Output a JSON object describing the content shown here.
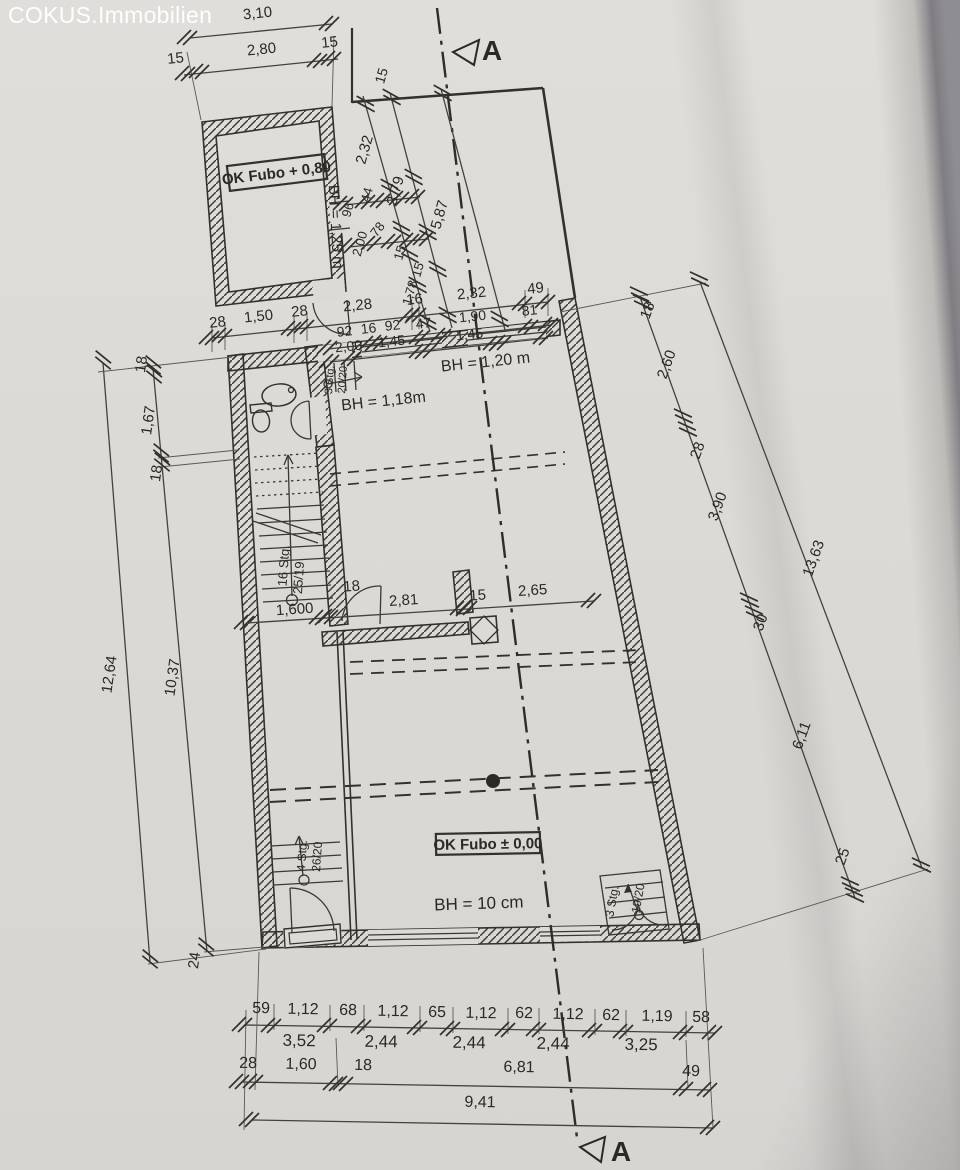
{
  "watermark": "COKUS.Immobilien",
  "drawing_colors": {
    "ink": "#34312d",
    "paper": "#dcdad7"
  },
  "labels": [
    {
      "t": "3,10",
      "x": 258,
      "y": 18,
      "r": -6
    },
    {
      "t": "15",
      "x": 176,
      "y": 63,
      "r": -6
    },
    {
      "t": "2,80",
      "x": 262,
      "y": 54,
      "r": -6
    },
    {
      "t": "15",
      "x": 330,
      "y": 47,
      "r": -6
    },
    {
      "t": "15",
      "x": 386,
      "y": 77,
      "r": -74,
      "s": 14
    },
    {
      "t": "2,32",
      "x": 369,
      "y": 151,
      "r": -74
    },
    {
      "t": "3,79",
      "x": 400,
      "y": 192,
      "r": -74
    },
    {
      "t": "5,87",
      "x": 444,
      "y": 216,
      "r": -74
    },
    {
      "t": "44",
      "x": 371,
      "y": 196,
      "r": -74,
      "s": 13
    },
    {
      "t": "96",
      "x": 352,
      "y": 211,
      "r": -74,
      "s": 13
    },
    {
      "t": "78",
      "x": 381,
      "y": 232,
      "r": -52,
      "s": 13
    },
    {
      "t": "2,00",
      "x": 364,
      "y": 245,
      "r": -74,
      "s": 13
    },
    {
      "t": "15",
      "x": 404,
      "y": 254,
      "r": -74,
      "s": 13
    },
    {
      "t": "15",
      "x": 422,
      "y": 271,
      "r": -74,
      "s": 13
    },
    {
      "t": "1,78",
      "x": 414,
      "y": 294,
      "r": -74,
      "s": 13
    },
    {
      "t": "28",
      "x": 218,
      "y": 327,
      "r": -6
    },
    {
      "t": "1,50",
      "x": 259,
      "y": 321,
      "r": -6
    },
    {
      "t": "28",
      "x": 300,
      "y": 316,
      "r": -6
    },
    {
      "t": "2,28",
      "x": 358,
      "y": 310,
      "r": -6
    },
    {
      "t": "16",
      "x": 415,
      "y": 304,
      "r": -6
    },
    {
      "t": "2,32",
      "x": 472,
      "y": 298,
      "r": -6
    },
    {
      "t": "49",
      "x": 536,
      "y": 293,
      "r": -6
    },
    {
      "t": "92",
      "x": 345,
      "y": 336,
      "r": -6,
      "s": 14
    },
    {
      "t": "16",
      "x": 369,
      "y": 333,
      "r": -6,
      "s": 14
    },
    {
      "t": "92",
      "x": 393,
      "y": 330,
      "r": -6,
      "s": 14
    },
    {
      "t": "47",
      "x": 424,
      "y": 328,
      "r": -6,
      "s": 14
    },
    {
      "t": "1,90",
      "x": 473,
      "y": 321,
      "r": -6,
      "s": 14
    },
    {
      "t": "81",
      "x": 530,
      "y": 315,
      "r": -6,
      "s": 14
    },
    {
      "t": "2,00",
      "x": 349,
      "y": 351,
      "r": -6,
      "s": 14
    },
    {
      "t": "1,45",
      "x": 392,
      "y": 346,
      "r": -6,
      "s": 14
    },
    {
      "t": "1,45",
      "x": 470,
      "y": 339,
      "r": -6,
      "s": 14
    },
    {
      "t": "18",
      "x": 652,
      "y": 312,
      "r": -70
    },
    {
      "t": "2,60",
      "x": 671,
      "y": 366,
      "r": -70
    },
    {
      "t": "28",
      "x": 702,
      "y": 452,
      "r": -70
    },
    {
      "t": "3,90",
      "x": 722,
      "y": 508,
      "r": -70
    },
    {
      "t": "30",
      "x": 765,
      "y": 624,
      "r": -70
    },
    {
      "t": "6,11",
      "x": 806,
      "y": 737,
      "r": -70
    },
    {
      "t": "25",
      "x": 847,
      "y": 858,
      "r": -70
    },
    {
      "t": "13,63",
      "x": 818,
      "y": 560,
      "r": -70
    },
    {
      "t": "18",
      "x": 146,
      "y": 365,
      "r": -82
    },
    {
      "t": "1,67",
      "x": 153,
      "y": 421,
      "r": -82
    },
    {
      "t": "18",
      "x": 161,
      "y": 474,
      "r": -82
    },
    {
      "t": "10,37",
      "x": 177,
      "y": 678,
      "r": -82
    },
    {
      "t": "12,64",
      "x": 114,
      "y": 675,
      "r": -82
    },
    {
      "t": "24",
      "x": 199,
      "y": 961,
      "r": -82
    },
    {
      "t": "1,600",
      "x": 295,
      "y": 614,
      "r": -4
    },
    {
      "t": "18",
      "x": 352,
      "y": 591,
      "r": -4
    },
    {
      "t": "2,81",
      "x": 404,
      "y": 605,
      "r": -4
    },
    {
      "t": "15",
      "x": 478,
      "y": 600,
      "r": -4
    },
    {
      "t": "2,65",
      "x": 533,
      "y": 595,
      "r": -4
    },
    {
      "t": "59",
      "x": 261,
      "y": 1013,
      "r": 1,
      "s": 16
    },
    {
      "t": "1,12",
      "x": 303,
      "y": 1014,
      "r": 1,
      "s": 16
    },
    {
      "t": "68",
      "x": 348,
      "y": 1015,
      "r": 1,
      "s": 16
    },
    {
      "t": "1,12",
      "x": 393,
      "y": 1016,
      "r": 1,
      "s": 16
    },
    {
      "t": "65",
      "x": 437,
      "y": 1017,
      "r": 1,
      "s": 16
    },
    {
      "t": "1,12",
      "x": 481,
      "y": 1018,
      "r": 1,
      "s": 16
    },
    {
      "t": "62",
      "x": 524,
      "y": 1018,
      "r": 1,
      "s": 16
    },
    {
      "t": "1,12",
      "x": 568,
      "y": 1019,
      "r": 1,
      "s": 16
    },
    {
      "t": "62",
      "x": 611,
      "y": 1020,
      "r": 1,
      "s": 16
    },
    {
      "t": "1,19",
      "x": 657,
      "y": 1021,
      "r": 1,
      "s": 16
    },
    {
      "t": "58",
      "x": 701,
      "y": 1022,
      "r": 1,
      "s": 16
    },
    {
      "t": "3,52",
      "x": 299,
      "y": 1046,
      "r": 1,
      "s": 17
    },
    {
      "t": "2,44",
      "x": 381,
      "y": 1047,
      "r": 1,
      "s": 17
    },
    {
      "t": "2,44",
      "x": 469,
      "y": 1048,
      "r": 1,
      "s": 17
    },
    {
      "t": "2,44",
      "x": 553,
      "y": 1049,
      "r": 1,
      "s": 17
    },
    {
      "t": "3,25",
      "x": 641,
      "y": 1050,
      "r": 1,
      "s": 17
    },
    {
      "t": "28",
      "x": 248,
      "y": 1068,
      "r": 1,
      "s": 16
    },
    {
      "t": "1,60",
      "x": 301,
      "y": 1069,
      "r": 1,
      "s": 16
    },
    {
      "t": "18",
      "x": 363,
      "y": 1070,
      "r": 1,
      "s": 16
    },
    {
      "t": "6,81",
      "x": 519,
      "y": 1072,
      "r": 1,
      "s": 16
    },
    {
      "t": "49",
      "x": 691,
      "y": 1076,
      "r": 1,
      "s": 16
    },
    {
      "t": "9,41",
      "x": 480,
      "y": 1107,
      "r": 1,
      "s": 16
    },
    {
      "t": "BH = 1,25 m",
      "x": 331,
      "y": 227,
      "r": 87,
      "s": 15,
      "n": "bh-label-annex"
    },
    {
      "t": "BH = 1,20 m",
      "x": 486,
      "y": 367,
      "r": -6,
      "s": 16,
      "n": "bh-label-window-right"
    },
    {
      "t": "BH = 1,18m",
      "x": 384,
      "y": 406,
      "r": -6,
      "s": 16,
      "n": "bh-label-window-left"
    },
    {
      "t": "BH = 10 cm",
      "x": 479,
      "y": 909,
      "r": -2,
      "s": 17,
      "n": "bh-label-ground"
    },
    {
      "t": "16 Stg.",
      "x": 288,
      "y": 566,
      "r": -86,
      "s": 13,
      "n": "stair-label-main"
    },
    {
      "t": "25/19",
      "x": 303,
      "y": 578,
      "r": -86,
      "s": 13,
      "n": "stair-label-main-ratio"
    },
    {
      "t": "3 Stg.",
      "x": 333,
      "y": 380,
      "r": -86,
      "s": 11,
      "n": "stair-label-upper"
    },
    {
      "t": "20/20",
      "x": 346,
      "y": 380,
      "r": -86,
      "s": 11,
      "n": "stair-label-upper-ratio"
    },
    {
      "t": "4 Stg.",
      "x": 306,
      "y": 856,
      "r": -86,
      "s": 12,
      "n": "stair-label-cellar"
    },
    {
      "t": "26/20",
      "x": 321,
      "y": 857,
      "r": -86,
      "s": 12,
      "n": "stair-label-cellar-ratio"
    },
    {
      "t": "3 Stg.",
      "x": 616,
      "y": 902,
      "r": -80,
      "s": 12,
      "n": "stair-label-entry"
    },
    {
      "t": "19/20",
      "x": 642,
      "y": 899,
      "r": -80,
      "s": 12,
      "n": "stair-label-entry-ratio"
    },
    {
      "t": "OK Fubo + 0,80",
      "x": 277,
      "y": 178,
      "r": -7,
      "s": 15,
      "b": 1,
      "n": "floor-level-label-upper"
    },
    {
      "t": "OK Fubo ± 0,00",
      "x": 488,
      "y": 849,
      "r": -1,
      "s": 15,
      "b": 1,
      "n": "floor-level-label-ground"
    },
    {
      "t": "A",
      "x": 492,
      "y": 60,
      "r": 0,
      "s": 28,
      "b": 1,
      "n": "section-letter-top"
    },
    {
      "t": "A",
      "x": 621,
      "y": 1161,
      "r": 0,
      "s": 28,
      "b": 1,
      "n": "section-letter-bottom"
    }
  ]
}
